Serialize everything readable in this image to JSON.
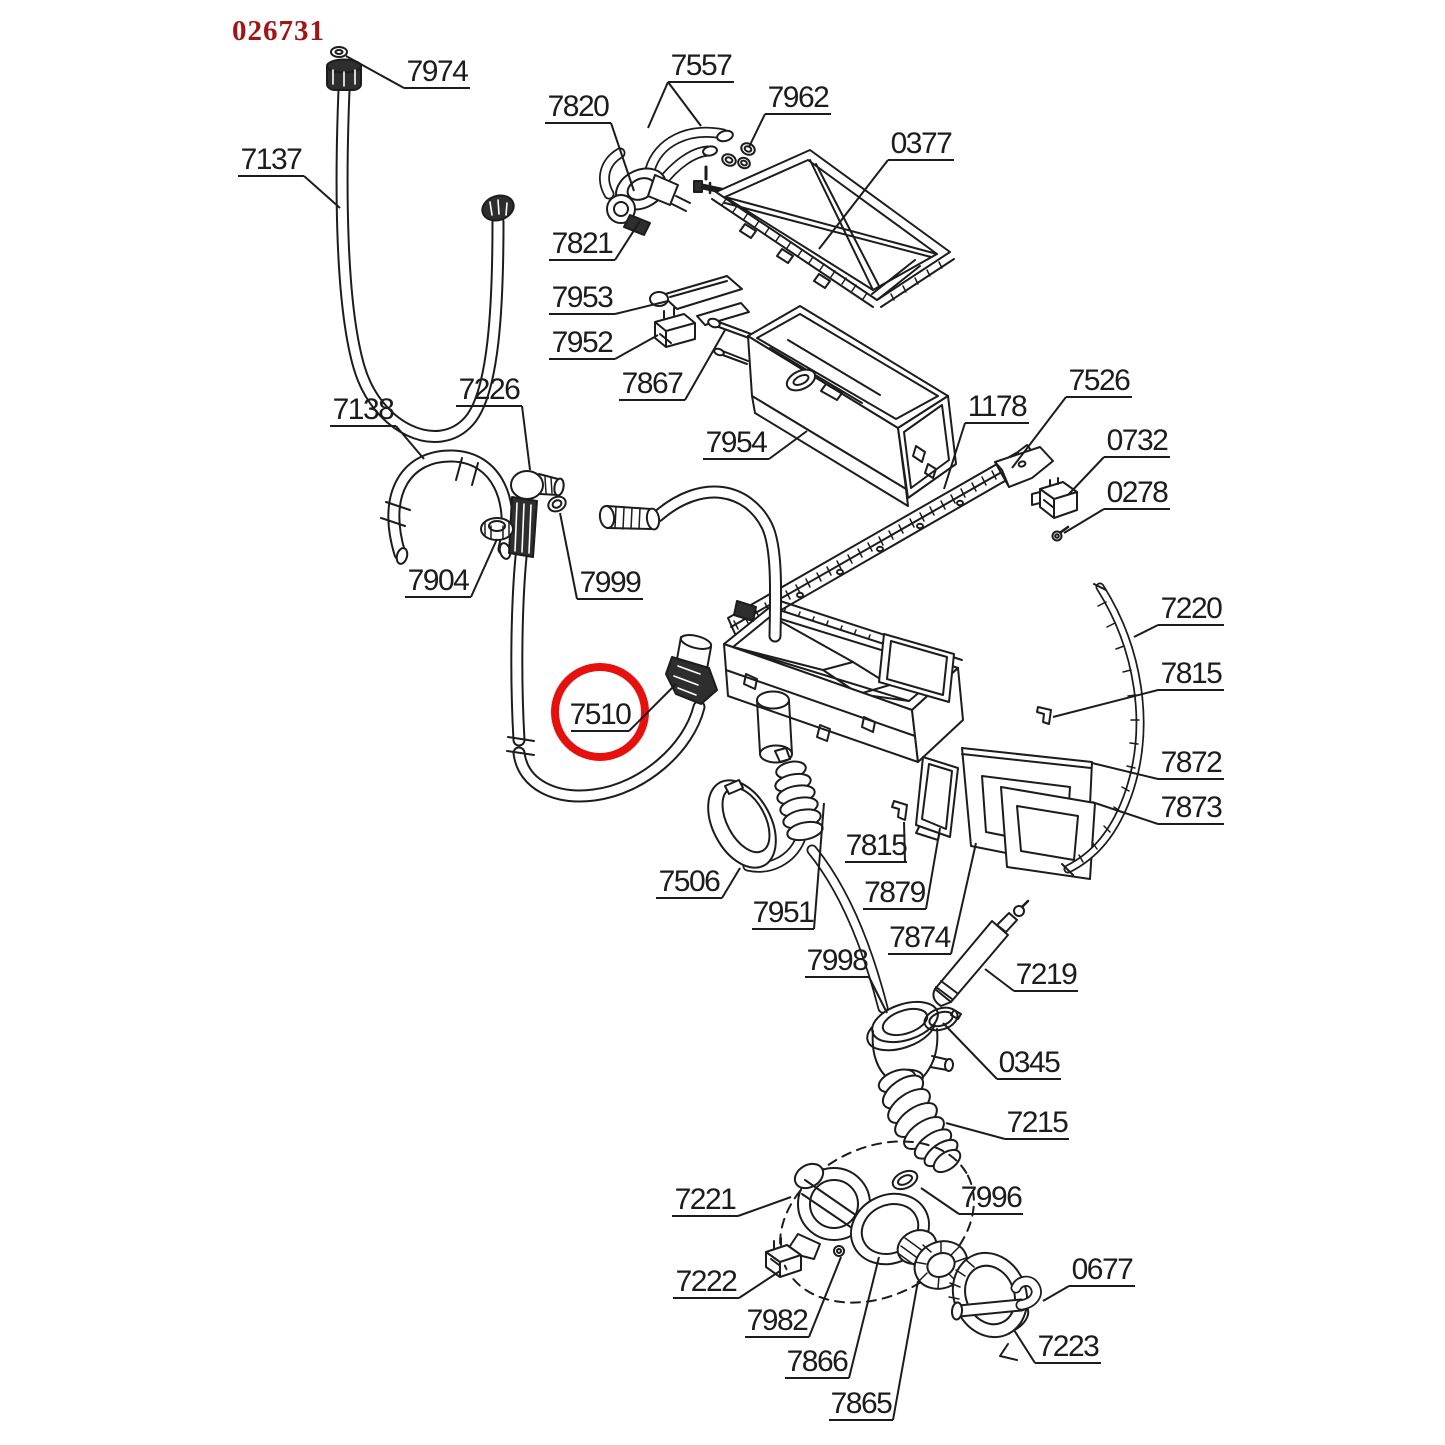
{
  "page": {
    "background": "#ffffff",
    "kind": "exploded-parts-diagram"
  },
  "header": {
    "doc_number": "026731",
    "doc_number_color": "#a31515",
    "x": 232,
    "y": 40
  },
  "diagram": {
    "line_color": "#1c1c1c",
    "highlight": {
      "part": "7510",
      "color": "#e8100c",
      "circle": {
        "cx": 600,
        "cy": 712,
        "r": 45,
        "stroke_width": 8
      }
    },
    "callouts": [
      {
        "part": "7974",
        "ul": [
          404,
          470,
          88
        ],
        "leaders": [
          [
            [
              404,
              88
            ],
            [
              346,
              56
            ]
          ]
        ]
      },
      {
        "part": "7137",
        "ul": [
          238,
          304,
          176
        ],
        "leaders": [
          [
            [
              304,
              176
            ],
            [
              340,
              208
            ]
          ]
        ]
      },
      {
        "part": "7820",
        "ul": [
          545,
          611,
          123
        ],
        "leaders": [
          [
            [
              611,
              123
            ],
            [
              634,
              191
            ]
          ]
        ]
      },
      {
        "part": "7557",
        "ul": [
          668,
          734,
          82
        ],
        "leaders": [
          [
            [
              668,
              82
            ],
            [
              648,
              128
            ]
          ],
          [
            [
              668,
              82
            ],
            [
              701,
              126
            ]
          ]
        ]
      },
      {
        "part": "7962",
        "ul": [
          765,
          831,
          114
        ],
        "leaders": [
          [
            [
              765,
              114
            ],
            [
              749,
              147
            ]
          ]
        ]
      },
      {
        "part": "0377",
        "ul": [
          888,
          954,
          160
        ],
        "leaders": [
          [
            [
              888,
              160
            ],
            [
              819,
              249
            ]
          ]
        ]
      },
      {
        "part": "7821",
        "ul": [
          549,
          615,
          260
        ],
        "leaders": [
          [
            [
              615,
              260
            ],
            [
              640,
              221
            ]
          ]
        ]
      },
      {
        "part": "7953",
        "ul": [
          549,
          615,
          314
        ],
        "leaders": [
          [
            [
              615,
              314
            ],
            [
              668,
              301
            ]
          ]
        ]
      },
      {
        "part": "7952",
        "ul": [
          549,
          615,
          359
        ],
        "leaders": [
          [
            [
              615,
              359
            ],
            [
              658,
              335
            ]
          ]
        ]
      },
      {
        "part": "7867",
        "ul": [
          619,
          685,
          400
        ],
        "leaders": [
          [
            [
              685,
              400
            ],
            [
              725,
              330
            ]
          ]
        ]
      },
      {
        "part": "7954",
        "ul": [
          703,
          769,
          459
        ],
        "leaders": [
          [
            [
              769,
              459
            ],
            [
              807,
              431
            ]
          ]
        ]
      },
      {
        "part": "1178",
        "ul": [
          965,
          1029,
          423
        ],
        "leaders": [
          [
            [
              965,
              423
            ],
            [
              944,
              489
            ]
          ]
        ]
      },
      {
        "part": "7526",
        "ul": [
          1066,
          1132,
          397
        ],
        "leaders": [
          [
            [
              1066,
              397
            ],
            [
              1012,
              468
            ]
          ]
        ]
      },
      {
        "part": "0732",
        "ul": [
          1104,
          1170,
          457
        ],
        "leaders": [
          [
            [
              1104,
              457
            ],
            [
              1068,
              495
            ]
          ]
        ]
      },
      {
        "part": "0278",
        "ul": [
          1104,
          1170,
          509
        ],
        "leaders": [
          [
            [
              1104,
              509
            ],
            [
              1064,
              533
            ]
          ]
        ]
      },
      {
        "part": "7138",
        "ul": [
          330,
          396,
          426
        ],
        "leaders": [
          [
            [
              396,
              426
            ],
            [
              424,
              459
            ]
          ]
        ]
      },
      {
        "part": "7226",
        "ul": [
          456,
          522,
          406
        ],
        "leaders": [
          [
            [
              522,
              406
            ],
            [
              530,
              470
            ]
          ]
        ]
      },
      {
        "part": "7904",
        "ul": [
          405,
          471,
          597
        ],
        "leaders": [
          [
            [
              471,
              597
            ],
            [
              497,
              539
            ]
          ]
        ]
      },
      {
        "part": "7999",
        "ul": [
          577,
          643,
          599
        ],
        "leaders": [
          [
            [
              577,
              599
            ],
            [
              560,
              513
            ]
          ]
        ]
      },
      {
        "part": "7220",
        "ul": [
          1158,
          1224,
          625
        ],
        "leaders": [
          [
            [
              1158,
              625
            ],
            [
              1134,
              637
            ]
          ]
        ]
      },
      {
        "part": "7815",
        "ul": [
          1158,
          1224,
          690
        ],
        "leaders": [
          [
            [
              1158,
              690
            ],
            [
              1053,
              717
            ]
          ]
        ]
      },
      {
        "part": "7872",
        "ul": [
          1158,
          1224,
          779
        ],
        "leaders": [
          [
            [
              1158,
              779
            ],
            [
              1092,
              763
            ]
          ]
        ]
      },
      {
        "part": "7873",
        "ul": [
          1158,
          1224,
          824
        ],
        "leaders": [
          [
            [
              1158,
              824
            ],
            [
              1092,
              802
            ]
          ]
        ]
      },
      {
        "part": "7510",
        "ul": [
          571,
          629,
          731
        ],
        "leaders": [
          [
            [
              629,
              731
            ],
            [
              676,
              684
            ]
          ]
        ],
        "highlighted": true
      },
      {
        "part": "7506",
        "ul": [
          656,
          722,
          898
        ],
        "leaders": [
          [
            [
              722,
              898
            ],
            [
              740,
              868
            ]
          ]
        ]
      },
      {
        "part": "7815",
        "ul": [
          845,
          907,
          862
        ],
        "leaders": [
          [
            [
              905,
              862
            ],
            [
              904,
              822
            ]
          ]
        ]
      },
      {
        "part": "7879",
        "ul": [
          863,
          926,
          909
        ],
        "leaders": [
          [
            [
              926,
              909
            ],
            [
              940,
              828
            ]
          ]
        ]
      },
      {
        "part": "7951",
        "ul": [
          752,
          814,
          929
        ],
        "leaders": [
          [
            [
              814,
              929
            ],
            [
              824,
              803
            ]
          ]
        ]
      },
      {
        "part": "7874",
        "ul": [
          888,
          951,
          954
        ],
        "leaders": [
          [
            [
              951,
              954
            ],
            [
              976,
              843
            ]
          ]
        ]
      },
      {
        "part": "7998",
        "ul": [
          805,
          869,
          977
        ],
        "leaders": [
          [
            [
              869,
              977
            ],
            [
              887,
              1013
            ]
          ]
        ]
      },
      {
        "part": "7219",
        "ul": [
          1014,
          1078,
          991
        ],
        "leaders": [
          [
            [
              1014,
              991
            ],
            [
              985,
              969
            ]
          ]
        ]
      },
      {
        "part": "0345",
        "ul": [
          997,
          1061,
          1079
        ],
        "leaders": [
          [
            [
              997,
              1079
            ],
            [
              943,
              1023
            ]
          ]
        ]
      },
      {
        "part": "7215",
        "ul": [
          1005,
          1069,
          1139
        ],
        "leaders": [
          [
            [
              1005,
              1139
            ],
            [
              946,
              1123
            ]
          ]
        ]
      },
      {
        "part": "7221",
        "ul": [
          672,
          738,
          1216
        ],
        "leaders": [
          [
            [
              738,
              1216
            ],
            [
              791,
              1197
            ]
          ]
        ]
      },
      {
        "part": "7996",
        "ul": [
          959,
          1023,
          1214
        ],
        "leaders": [
          [
            [
              959,
              1214
            ],
            [
              921,
              1188
            ]
          ]
        ]
      },
      {
        "part": "7222",
        "ul": [
          673,
          739,
          1298
        ],
        "leaders": [
          [
            [
              739,
              1298
            ],
            [
              780,
              1271
            ]
          ]
        ]
      },
      {
        "part": "0677",
        "ul": [
          1069,
          1135,
          1286
        ],
        "leaders": [
          [
            [
              1069,
              1286
            ],
            [
              1043,
              1301
            ]
          ]
        ]
      },
      {
        "part": "7982",
        "ul": [
          745,
          809,
          1337
        ],
        "leaders": [
          [
            [
              809,
              1337
            ],
            [
              841,
              1257
            ]
          ]
        ]
      },
      {
        "part": "7866",
        "ul": [
          785,
          849,
          1378
        ],
        "leaders": [
          [
            [
              849,
              1378
            ],
            [
              879,
              1257
            ]
          ]
        ]
      },
      {
        "part": "7223",
        "ul": [
          1035,
          1101,
          1363
        ],
        "leaders": [
          [
            [
              1035,
              1363
            ],
            [
              1014,
              1330
            ]
          ]
        ]
      },
      {
        "part": "7865",
        "ul": [
          829,
          893,
          1420
        ],
        "leaders": [
          [
            [
              893,
              1420
            ],
            [
              918,
              1281
            ]
          ]
        ]
      }
    ]
  }
}
